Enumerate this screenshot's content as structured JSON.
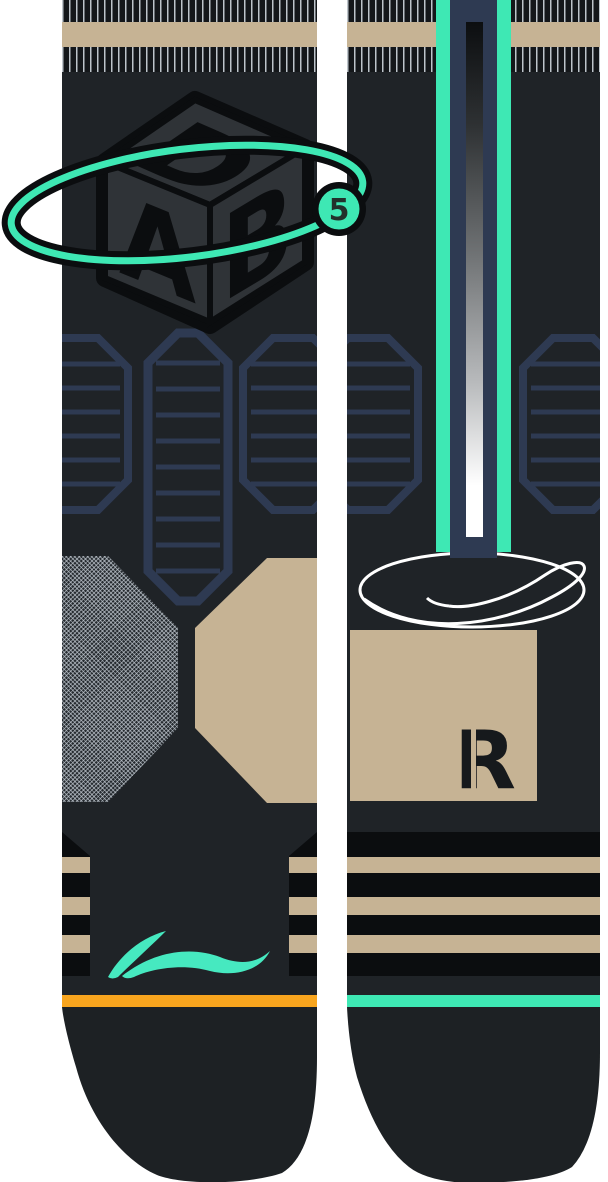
{
  "dab_logo": {
    "letter_top": "D",
    "letter_left": "A",
    "letter_right": "B",
    "badge": "5"
  },
  "right_sock": {
    "size_letter": "R"
  },
  "icons": {
    "dab_cube": "dab-cube-icon",
    "orbit_ring": "orbit-ring-icon",
    "li_ning_swoosh": "li-ning-swoosh-icon",
    "ellipse_swoosh": "ellipse-swoosh-icon",
    "hex_knit_pattern": "hex-pattern-icon"
  },
  "colors": {
    "teal_accent": "#3EE8B4",
    "tan": "#C6B394",
    "orange": "#F8A51E",
    "navy_pattern": "#2E3A52",
    "body_charcoal": "#1F2327",
    "black": "#0B0D0F",
    "cube_gray": "#2F3337",
    "mesh_gray": "#9AA2A8",
    "gradient_top": "#0C0E10",
    "gradient_bottom": "#FFFFFF",
    "white": "#FFFFFF"
  }
}
